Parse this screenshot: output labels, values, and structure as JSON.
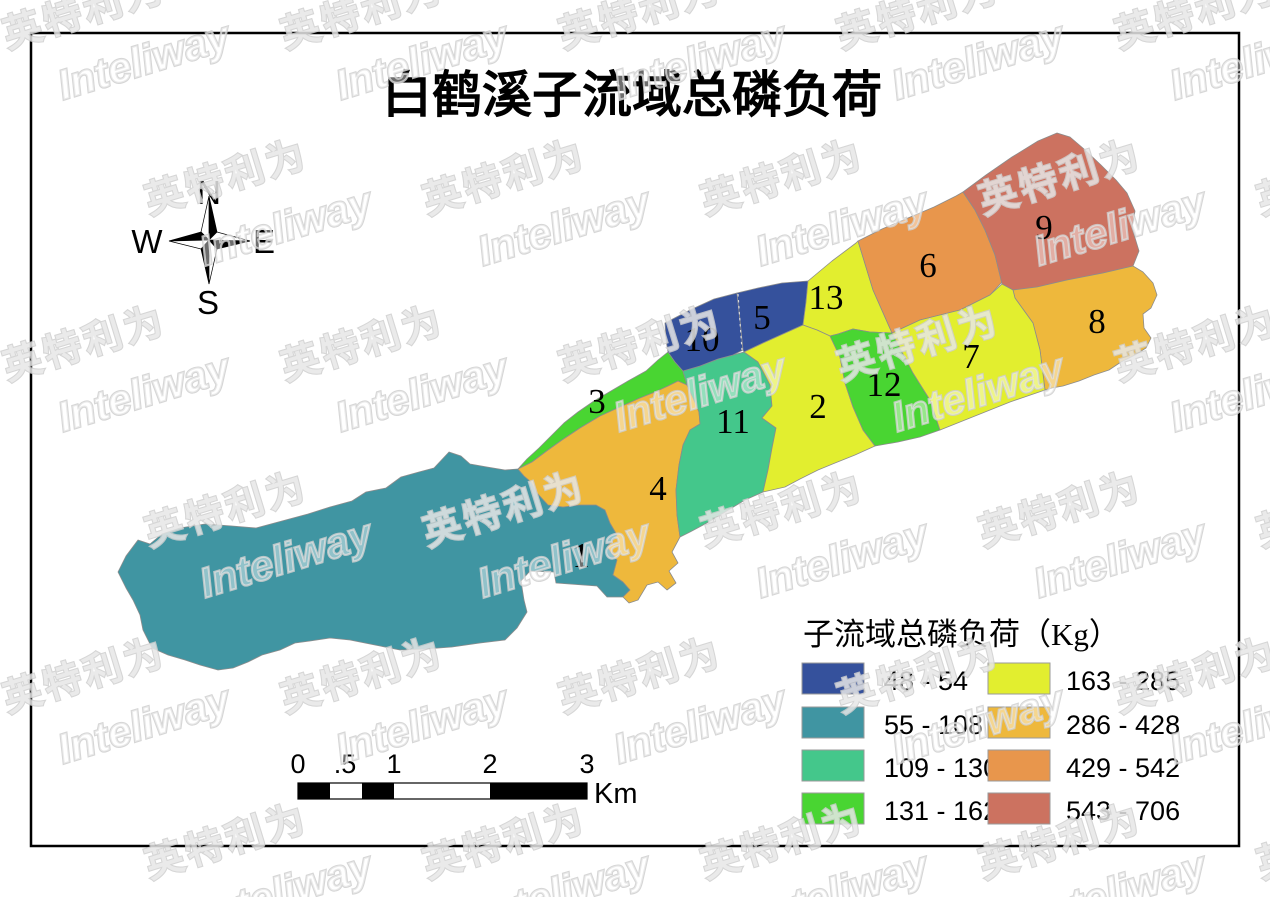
{
  "title": "白鹤溪子流域总磷负荷",
  "compass": {
    "n": "N",
    "e": "E",
    "s": "S",
    "w": "W"
  },
  "watermark": {
    "latin": "Inteliway",
    "cjk": "英特利为"
  },
  "legend": {
    "title": "子流域总磷负荷（Kg）",
    "items": [
      {
        "range": "48 - 54",
        "color": "#35519c"
      },
      {
        "range": "55 - 108",
        "color": "#4095a2"
      },
      {
        "range": "109 - 130",
        "color": "#44c78b"
      },
      {
        "range": "131 - 162",
        "color": "#49d532"
      },
      {
        "range": "163 - 285",
        "color": "#e2ee2f"
      },
      {
        "range": "286 - 428",
        "color": "#eeb83c"
      },
      {
        "range": "429 - 542",
        "color": "#e8964c"
      },
      {
        "range": "543 - 706",
        "color": "#cc7260"
      }
    ]
  },
  "scalebar": {
    "ticks": [
      "0",
      ".5",
      "1",
      "2",
      "3"
    ],
    "unit": "Km"
  },
  "map": {
    "divider": {
      "x1": 738,
      "y1": 294,
      "x2": 742,
      "y2": 350
    },
    "regions": [
      {
        "id": "1",
        "legend_index": 1,
        "label_x": 581,
        "label_y": 567,
        "points": "118,572 126,556 138,540 150,544 162,534 180,528 205,524 232,526 256,528 282,521 308,514 330,507 352,501 366,492 386,488 401,477 419,472 434,468 449,452 461,456 470,464 487,467 505,470 518,469 524,476 531,482 537,493 548,505 563,507 580,505 596,505 605,510 610,523 617,535 607,547 617,560 613,575 623,582 630,590 623,597 607,597 597,586 556,583 554,572 530,571 521,581 524,600 527,612 517,628 505,640 480,643 452,647 425,649 400,650 375,645 350,640 330,638 310,641 295,643 280,650 262,655 248,662 233,668 218,670 200,665 185,660 168,655 152,648 143,630 140,615 133,600 126,588"
      },
      {
        "id": "3",
        "legend_index": 3,
        "label_x": 597,
        "label_y": 413,
        "points": "518,469 527,459 539,448 552,435 564,423 578,412 594,401 611,391 628,381 646,371 658,360 668,352 675,362 683,371 685,378 687,385 678,381 668,386 655,392 640,398 622,406 600,416 580,428 562,440 548,450 532,462"
      },
      {
        "id": "4",
        "legend_index": 5,
        "label_x": 658,
        "label_y": 500,
        "points": "687,385 694,400 699,412 700,424 690,430 683,445 679,465 676,490 677,515 680,537 672,552 678,563 669,571 676,583 667,590 658,582 647,585 638,600 629,603 623,597 630,590 623,582 613,575 617,560 607,547 617,535 610,523 605,510 596,505 580,505 563,507 548,505 537,493 531,482 524,476 518,469 532,462 548,450 562,440 580,428 600,416 622,406 640,398 655,392 668,386 678,381"
      },
      {
        "id": "11",
        "legend_index": 2,
        "label_x": 733,
        "label_y": 433,
        "points": "683,371 700,366 718,359 733,355 744,352 758,362 770,385 772,406 762,418 776,428 772,448 768,470 763,492 745,500 725,512 705,524 690,532 680,537 677,515 676,490 679,465 683,445 690,430 700,424 699,412 694,400 687,385 685,378"
      },
      {
        "id": "10",
        "legend_index": 0,
        "label_x": 702,
        "label_y": 351,
        "points": "665,323 690,310 714,299 737,293 740,320 743,350 733,355 718,359 700,366 683,371 675,362 668,352 666,340"
      },
      {
        "id": "5",
        "legend_index": 0,
        "label_x": 762,
        "label_y": 329,
        "points": "737,293 758,288 782,283 808,281 806,302 803,325 783,334 763,343 744,352 743,350 740,320"
      },
      {
        "id": "13",
        "legend_index": 4,
        "label_x": 826,
        "label_y": 309,
        "points": "808,281 832,261 856,243 858,241 873,290 892,333 870,332 853,329 838,334 830,336 817,330 803,325 806,302"
      },
      {
        "id": "2",
        "legend_index": 4,
        "label_x": 818,
        "label_y": 418,
        "points": "744,352 763,343 783,334 803,325 817,330 830,336 840,357 845,383 853,407 863,430 875,446 855,455 835,463 818,470 800,479 785,487 763,492 768,470 772,448 776,428 762,418 772,406 770,385 758,362"
      },
      {
        "id": "12",
        "legend_index": 3,
        "label_x": 884,
        "label_y": 396,
        "points": "830,336 838,334 853,329 870,332 892,333 913,373 930,400 940,430 920,437 898,442 875,446 863,430 853,407 845,383 840,357"
      },
      {
        "id": "6",
        "legend_index": 6,
        "label_x": 928,
        "label_y": 277,
        "points": "858,241 882,229 908,218 934,207 956,196 963,192 975,210 985,230 995,255 1002,282 990,295 960,310 920,320 892,333 873,290"
      },
      {
        "id": "9",
        "legend_index": 7,
        "label_x": 1044,
        "label_y": 239,
        "points": "963,192 986,175 1012,157 1038,141 1057,133 1070,137 1084,149 1101,165 1116,180 1127,193 1135,211 1132,228 1139,251 1133,266 1103,273 1067,280 1037,287 1013,290 1002,284 995,255 985,230 975,210"
      },
      {
        "id": "8",
        "legend_index": 5,
        "label_x": 1097,
        "label_y": 333,
        "points": "1013,290 1037,287 1067,280 1103,273 1133,266 1143,272 1153,283 1157,295 1151,308 1143,314 1144,328 1151,338 1146,348 1135,355 1121,362 1109,370 1094,375 1079,381 1063,386 1052,388 1045,390 1040,350 1033,323 1015,298"
      },
      {
        "id": "7",
        "legend_index": 4,
        "label_x": 971,
        "label_y": 368,
        "points": "892,333 920,320 960,310 990,295 1002,284 1013,290 1015,298 1033,323 1040,350 1045,390 1010,402 975,416 945,428 940,430 930,400 913,373"
      }
    ]
  }
}
